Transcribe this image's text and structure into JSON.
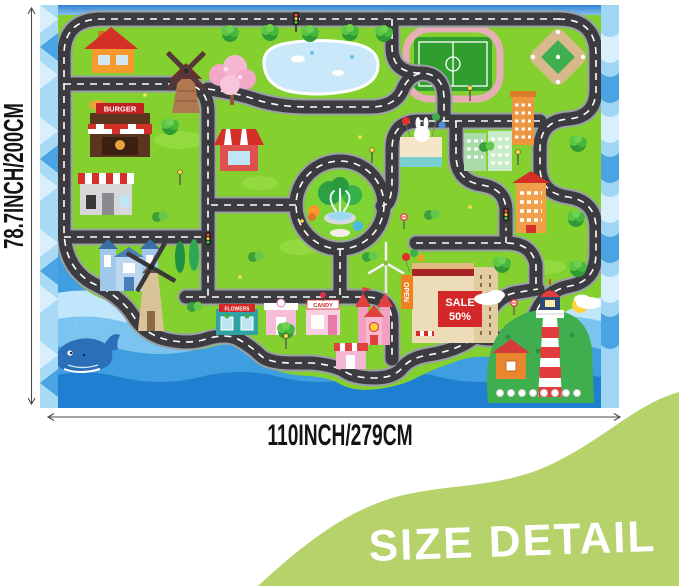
{
  "dimensions": {
    "height_label": "78.7INCH/200CM",
    "width_label": "110INCH/279CM"
  },
  "banner": {
    "label": "SIZE DETAIL",
    "background": "#b5d26b",
    "text_color": "#ffffff"
  },
  "mat": {
    "signs": {
      "burger": "BURGER",
      "sale_line1": "SALE",
      "sale_line2": "50%",
      "open": "OPEN",
      "candy": "CANDY",
      "flowers": "FLOWERS"
    },
    "colors": {
      "grass": "#84d02f",
      "road": "#3c3c40",
      "road_edge": "#9aa0a6",
      "road_line": "#ffffff",
      "water_deep": "#1f7fd0",
      "water_mid": "#54aee6",
      "water_light": "#bfe6fa",
      "border_strip": "#a8daf6",
      "lighthouse_red": "#e23c3c"
    },
    "features": [
      "fountain-roundabout",
      "soccer-field",
      "baseball-field",
      "pond",
      "burger-shop",
      "cafe",
      "brick-windmill",
      "tan-windmill",
      "cherry-blossom-tree",
      "blue-houses",
      "shopping-mall",
      "candy-shop",
      "flower-shop",
      "castle",
      "lighthouse",
      "whale",
      "wind-turbine"
    ]
  }
}
